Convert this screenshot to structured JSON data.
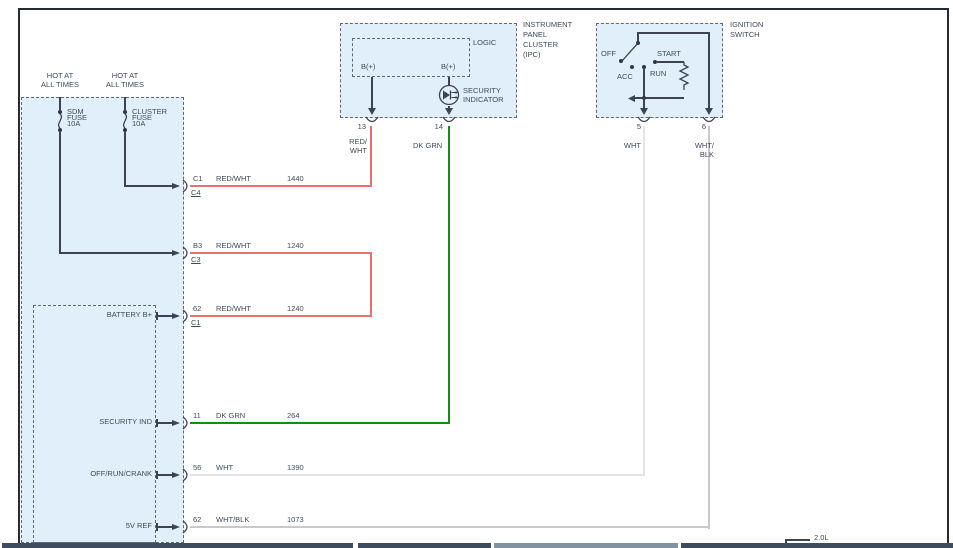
{
  "diagram": {
    "left": {
      "hot1": "HOT AT\nALL TIMES",
      "hot2": "HOT AT\nALL TIMES",
      "fuse1": "SDM\nFUSE\n10A",
      "fuse2": "CLUSTER\nFUSE\n10A",
      "rows": [
        {
          "label": "",
          "pin": "C1",
          "conn": "C4",
          "wire": "RED/WHT",
          "circuit": "1440"
        },
        {
          "label": "",
          "pin": "B3",
          "conn": "C3",
          "wire": "RED/WHT",
          "circuit": "1240"
        },
        {
          "label": "BATTERY B+",
          "pin": "62",
          "conn": "C1",
          "wire": "RED/WHT",
          "circuit": "1240"
        },
        {
          "label": "SECURITY IND",
          "pin": "11",
          "conn": "",
          "wire": "DK GRN",
          "circuit": "264"
        },
        {
          "label": "OFF/RUN/CRANK",
          "pin": "56",
          "conn": "",
          "wire": "WHT",
          "circuit": "1390"
        },
        {
          "label": "5V REF",
          "pin": "62",
          "conn": "",
          "wire": "WHT/BLK",
          "circuit": "1073"
        }
      ]
    },
    "ipc": {
      "title": "INSTRUMENT\nPANEL\nCLUSTER\n(IPC)",
      "logic": "LOGIC",
      "bplus_left": "B(+)",
      "bplus_right": "B(+)",
      "security": "SECURITY\nINDICATOR",
      "pin13": "13",
      "pin14": "14",
      "wire13": "RED/\nWHT",
      "wire14": "DK GRN"
    },
    "ignition": {
      "title": "IGNITION\nSWITCH",
      "off": "OFF",
      "acc": "ACC",
      "run": "RUN",
      "start": "START",
      "pin5": "5",
      "pin6": "6",
      "wire5": "WHT",
      "wire6": "WHT/\nBLK"
    },
    "footer": {
      "engine": "2.0L"
    },
    "colors": {
      "red_wire": "#e57373",
      "green_wire": "#178a17",
      "wht_wire": "#e4e4e6",
      "whtblk_wire": "#c9c9cc",
      "blue_fill": "#e0effa",
      "line": "#3c4454",
      "bar_dark": "#3f4b5e",
      "bar_light": "#8292a2"
    }
  }
}
